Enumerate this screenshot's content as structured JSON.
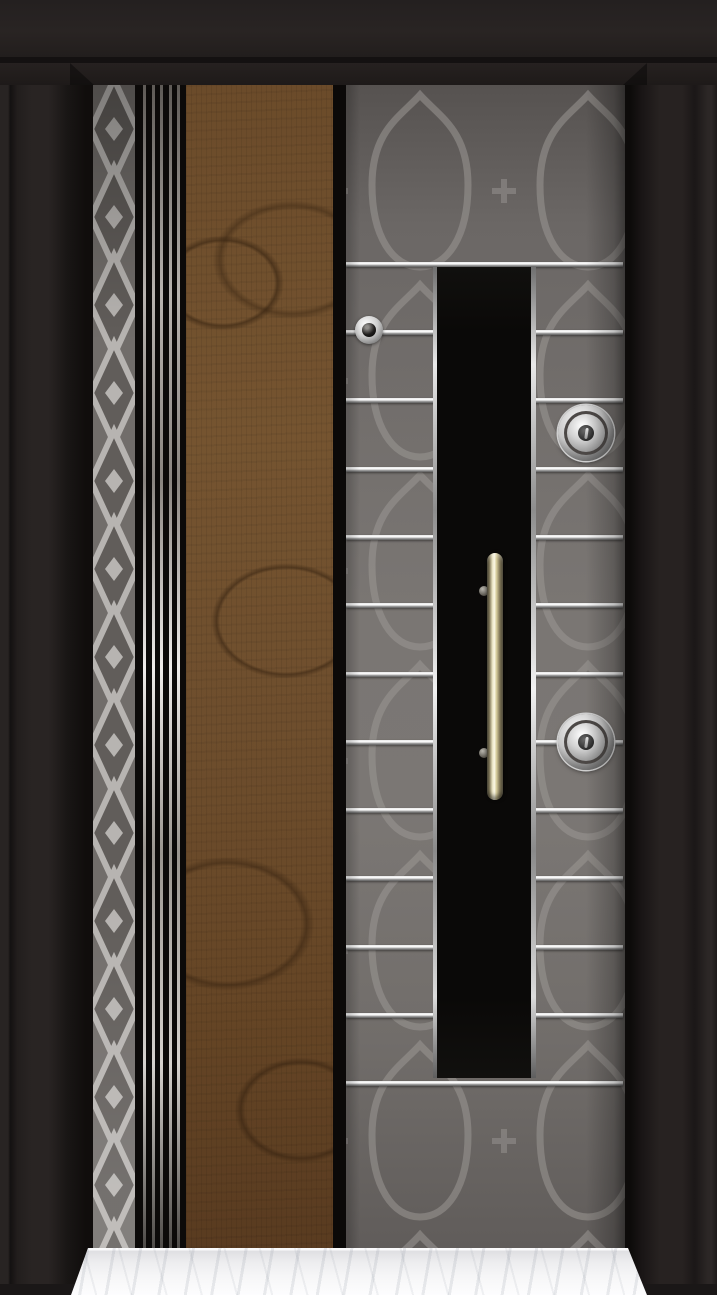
{
  "scene": {
    "label": "steel security door: black frame, gray diamond-lattice strip, vertical chrome lines, walnut wood panel, quatrefoil patterned gray panel with horizontal chrome strips, black center panel with brass pull handle, two chrome lock cylinders, peephole, white marble threshold"
  },
  "door": {
    "colors": {
      "frame": "#1d1919",
      "top_band": "#272221",
      "diamond_bg": "#716d6a",
      "diamond_light": "#b7b4b1",
      "diamond_dark": "#615d5a",
      "chrome": "#e9e9e9",
      "wood_base": "#6f4f2d",
      "panel_gray_mid": "#7a7673",
      "pattern_line": "#9a9694",
      "center_panel": "#0a0908",
      "handle_gold": "#fbf8e6",
      "marble": "#f6f6f7",
      "floor_shadow": "#1a1717"
    },
    "chrome_lines": {
      "offsets": [
        8,
        16.5,
        25,
        33.5,
        42
      ],
      "width": 3
    },
    "strips": {
      "ys_rel": [
        177,
        245,
        313,
        382,
        450,
        518,
        587,
        655,
        723,
        791,
        860,
        928,
        996
      ],
      "height": 5
    },
    "hardware": {
      "peephole": {
        "cx": 23,
        "cy": 245
      },
      "locks": [
        {
          "cx": 240,
          "cy": 348
        },
        {
          "cx": 240,
          "cy": 657
        }
      ],
      "handle_standoffs_cy": [
        506,
        668
      ]
    }
  }
}
